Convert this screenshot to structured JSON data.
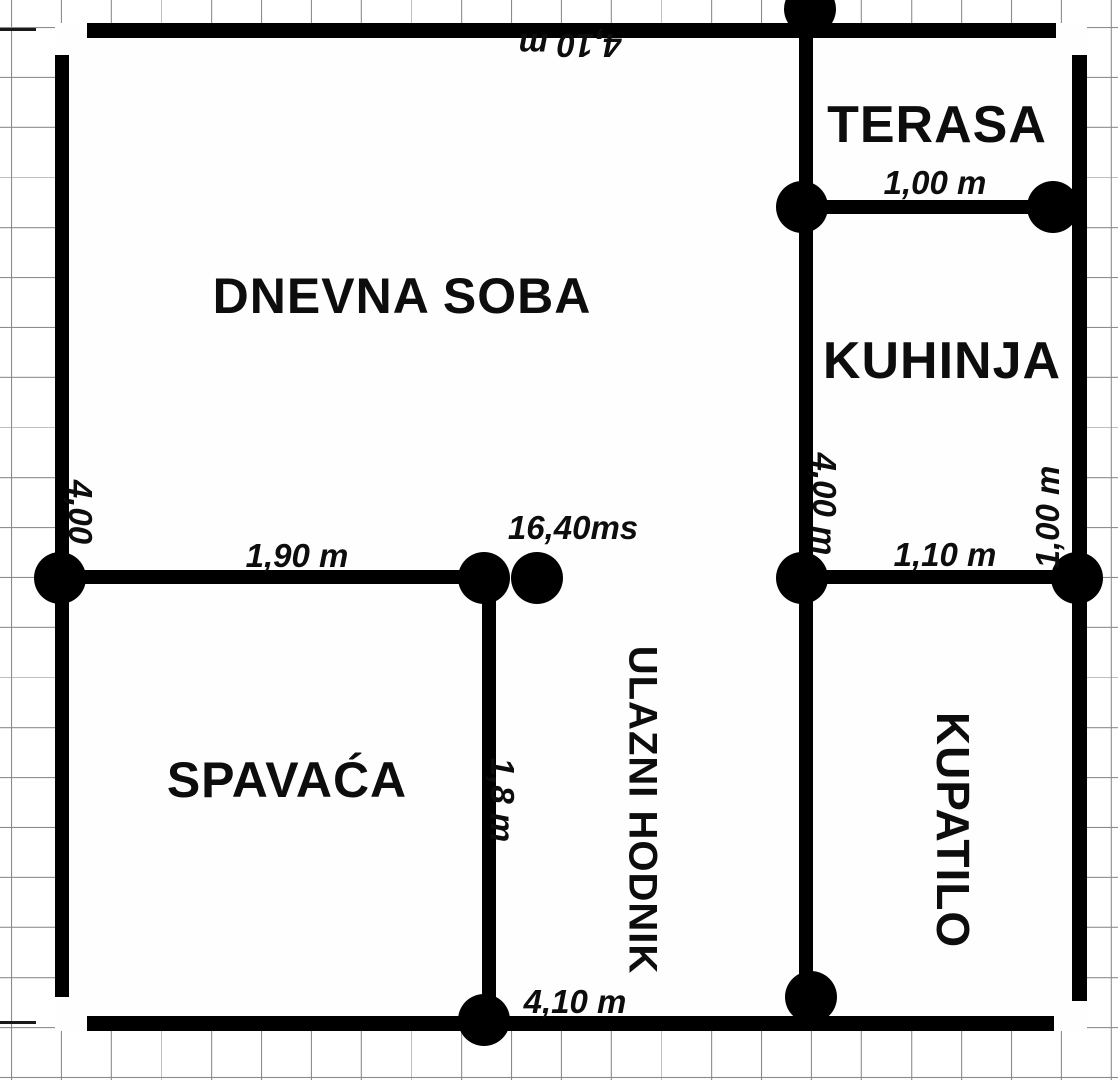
{
  "labels": {
    "dnevna_soba": "DNEVNA SOBA",
    "terasa": "TERASA",
    "kuhinja": "KUHINJA",
    "spavaca": "SPAVAĆA",
    "ulazni_hodnik": "ULAZNI HODNIK",
    "kupatilo": "KUPATILO"
  },
  "dimensions": {
    "top_width": "4,10 m",
    "terasa_width": "1,00 m",
    "left_height": "4,00",
    "bedroom_door": "1,90 m",
    "area": "16,40ms",
    "kitchen_height": "4,00 m",
    "kitchen_right_height": "1,00 m",
    "kitchen_door": "1,10 m",
    "hall_width": "1,8 m",
    "bottom_width": "4,10 m"
  },
  "colors": {
    "wall": "#000000",
    "grid_line": "#8a8a8a",
    "background": "#ffffff",
    "text": "#0d0d0d"
  }
}
